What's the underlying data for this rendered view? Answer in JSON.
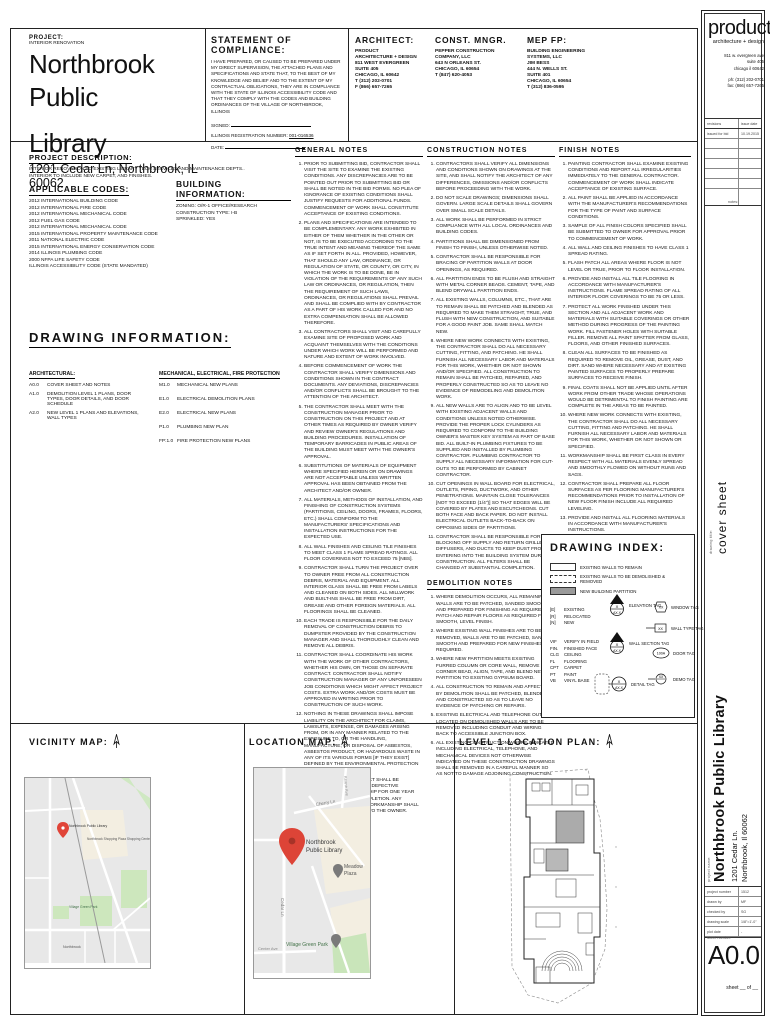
{
  "header": {
    "project_label": "PROJECT:",
    "project_sub": "INTERIOR RENOVATION",
    "project_name_line1": "Northbrook Public",
    "project_name_line2": "Library",
    "project_address": "1201 Cedar Ln, Northbrook, IL 60062",
    "compliance": {
      "title": "STATEMENT OF COMPLIANCE:",
      "body": "I HAVE PREPARED, OR CAUSED TO BE PREPARED UNDER MY DIRECT SUPERVISION, THE ATTACHED PLANS AND SPECIFICATIONS AND STATE THAT, TO THE BEST OF MY KNOWLEDGE AND BELIEF AND TO THE EXTENT OF MY CONTRACTUAL OBLIGATIONS, THEY ARE IN COMPLIANCE WITH THE STATE OF ILLINOIS ACCESSIBILITY CODE AND THAT THEY COMPLY WITH THE CODES AND BUILDING ORDINANCES OF THE VILLAGE OF NORTHBROOK, ILLINOIS",
      "signed_label": "SIGNED:",
      "reg_label": "ILLINOIS REGISTRATION NUMBER:",
      "reg_value": "001-016536",
      "date_label": "DATE:"
    },
    "architect": {
      "title": "ARCHITECT:",
      "lines": [
        "PRODUCT",
        "ARCHITECTURE + DESIGN",
        "",
        "811 WEST EVERGREEN",
        "SUITE 405",
        "CHICAGO, IL 60642",
        "T (312) 202-0701",
        "F (866) 657-7265"
      ]
    },
    "const_mngr": {
      "title": "CONST. MNGR.",
      "lines": [
        "PEPPER CONSTRUCTION",
        "COMPANY, LLC",
        "",
        "643 N ORLEANS ST.",
        "CHICAGO, IL 60654",
        "T (847) 620-4053"
      ]
    },
    "mep": {
      "title": "MEP FP:",
      "lines": [
        "BUILDING ENGINEERING",
        "SYSTEMS, LLC",
        "",
        "JIM BESS",
        "444 N. WELLS ST.",
        "SUITE 401",
        "CHICAGO, IL 60654",
        "T (312) 836-0595"
      ]
    }
  },
  "left": {
    "project_description": {
      "title": "PROJECT DESCRIPTION:",
      "lines": [
        "INTERIOR RENOVATION TO EXISTING LIBRARY TECH SERVICES AND MAINTENANCE DEPTS..",
        "INTERIOR TO INCLUDE NEW CARPET, AND FINISHES."
      ]
    },
    "applicable_codes": {
      "title": "APPLICABLE CODES:",
      "items": [
        "2012 INTERNATIONAL BUILDING CODE",
        "2012 INTERNATIONAL FIRE CODE",
        "2012 INTERNATIONAL MECHANICAL CODE",
        "2012 FUEL GAS CODE",
        "2012 INTERNATIONAL MECHANICAL  CODE",
        "2015 INTERNATIONAL PROPERTY MAINTENANCE CODE",
        "2011 NATIONAL ELECTRIC CODE",
        "2015 INTERNATIONAL ENERGY CONSERVATION CODE",
        "2014 ILLINOIS PLUMBING CODE",
        "2000 NFPA LIFE SAFETY CODE",
        "ILLINOIS ACCESSIBILITY CODE (STATE MANDATED)"
      ]
    },
    "building_information": {
      "title": "BUILDING INFORMATION:",
      "items": [
        "ZONING: O/R-1 OFFICE/RESEARCH",
        "CONSTRUCTION TYPE: I-B",
        "SPRINKLED: YES"
      ]
    },
    "drawing_information": {
      "title": "DRAWING INFORMATION:",
      "architectural": {
        "heading": "ARCHITECTURAL:",
        "items": [
          {
            "n": "A0.0",
            "t": "COVER SHEET AND NOTES"
          },
          {
            "n": "A1.0",
            "t": "DEMOLITION LEVEL 1 PLANS, DOOR TYPES, DOOR DETAILS, AND DOOR SCHEDULE"
          },
          {
            "n": "A2.0",
            "t": "NEW LEVEL 1 PLANS AND ELEVATIONS, WALL TYPES"
          }
        ]
      },
      "mep": {
        "heading": "MECHANICAL, ELECTRICAL, FIRE PROTECTION",
        "items": [
          {
            "n": "M1.0",
            "t": "MECHANICAL NEW PLANS"
          },
          {
            "n": "E1.0",
            "t": "ELECTRICAL DEMOLITION PLANS"
          },
          {
            "n": "E2.0",
            "t": "ELECTRICAL NEW PLANS"
          },
          {
            "n": "P1.0",
            "t": "PLUMBING NEW PLAN"
          },
          {
            "n": "FP:1.0",
            "t": "FIRE PROTECTION NEW PLANS"
          }
        ]
      }
    }
  },
  "notes": {
    "general": {
      "title": "GENERAL NOTES",
      "items": [
        "PRIOR TO SUBMITTING BID, CONTRACTOR SHALL VISIT THE SITE TO EXAMINE THE EXISTING CONDITIONS. ANY DISCREPANCIES ARE TO BE POINTED OUT PRIOR TO SUBMITTING BID OR SHALL BE NOTED IN THE BID FORMS. NO PLEA OF IGNORANCE OF EXISTING CONDITIONS SHALL JUSTIFY REQUESTS FOR ADDITIONAL FUNDS. COMMENCEMENT OF WORK SHALL CONSTITUTE ACCEPTANCE OF EXISTING CONDITIONS.",
        "PLANS AND SPECIFICATIONS ARE INTENDED TO BE COMPLEMENTARY. ANY WORK EXHIBITED IN EITHER OF THEM WHETHER IN THE OTHER OR NOT, IS TO BE EXECUTED ACCORDING TO THE TRUE INTENT AND MEANING THEREOF THE SAME AS IF SET FORTH IN ALL. PROVIDED, HOWEVER, THAT SHOULD ANY LAW, ORDINANCE, OR REGULATION OF STATE, OR COUNTY, OR CITY, IN WHICH THE WORK IS TO BE DONE, BE IN VIOLATION OF THE REQUIREMENTS OF ANY SUCH LAW OR ORDINANCES, OR REGULATION, THEN THE REQUIREMENT OF SUCH LAWS, ORDINANCES, OR REGULATIONS SHALL PREVAIL AND SHALL BE COMPLIED WITH BY CONTRACTOR AS A PART OF HIS WORK CALLED FOR AND NO EXTRA COMPENSATION SHALL BE ALLOWED THEREFORE.",
        "ALL CONTRACTORS SHALL VISIT AND CAREFULLY EXAMINE SITE OF PROPOSED WORK AND ACQUAINT THEMSELVES WITH THE CONDITIONS UNDER WHICH WORK WILL BE PERFORMED AND NATURE AND EXTENT OF WORK INVOLVED.",
        "BEFORE COMMENCEMENT OF WORK THE CONTRACTOR SHALL VERIFY DIMENSIONS AND CONDITIONS SHOWN IN THE CONTRACT DOCUMENTS. ANY DEVIATIONS, DISCREPANCIES AND/OR CONFLICTS SHALL BE BROUGHT TO THE ATTENTION OF THE ARCHITECT.",
        "THE CONTRACTOR SHALL MEET WITH THE CONSTRUCTION MANAGER PRIOR TO CONSTRUCTION ON THIS PROJECT AND AT OTHER TIMES AS REQUIRED BY OWNER VERIFY AND REVIEW OWNER'S REGULATIONS AND BUILDING PROCEDURES. INSTALLATION OF TEMPORARY BARRICADES IN PUBLIC AREAS OF THE BUILDING MUST MEET WITH THE OWNER'S APPROVAL.",
        "SUBSTITUTIONS OF MATERIALS OF EQUIPMENT WHERE SPECIFIED HEREIN OR ON DRAWINGS ARE NOT ACCEPTABLE UNLESS WRITTEN APPROVAL HAS BEEN OBTAINED FROM THE ARCHITECT AND/OR OWNER.",
        "ALL MATERIALS, METHODS OF INSTALLATION, AND FINISHING OF CONSTRUCTION SYSTEMS (PARTITIONS, CEILING, DOORS, FRAMES, FLOORS, ETC.) SHALL CONFORM TO THE MANUFACTURERS' SPECIFICATIONS AND INSTALLATION INSTRUCTIONS FOR THE EXPECTED USE.",
        "ALL WALL FINISHES AND CEILING TILE FINISHES TO MEET CLASS 1 FLAME SPREAD RATINGS. ALL FLOOR COVERINGS NOT TO EXCEED 75 [NBS].",
        "CONTRACTOR SHALL TURN THE PROJECT OVER TO OWNER FREE FROM ALL CONSTRUCTION DEBRIS, MATERIAL AND EQUIPMENT. ALL INTERIOR GLASS SHALL BE FREE FROM LABELS AND CLEANED ON BOTH SIDES. ALL MILLWORK AND BUILT-INS SHALL BE FREE FROM DIRT, GREASE AND OTHER FOREIGN MATERIALS. ALL FLOORINGS SHALL BE CLEANED.",
        "EACH TRADE IS RESPONSIBLE FOR THE DAILY REMOVAL OF CONSTRUCTION DEBRIS TO DUMPSTER PROVIDED BY THE CONSTRUCTION MANAGER AND SHALL THOROUGHLY CLEAN AND REMOVE ALL DEBRIS.",
        "CONTRACTOR SHALL COORDINATE HIS WORK WITH THE WORK OF OTHER CONTRACTORS, WHETHER HIS OWN, OR THOSE ON SEPARATE CONTRACT. CONTRACTOR SHALL NOTIFY CONSTRUCTION MANAGER OF ANY UNFORESEEN JOB CONDITIONS WHICH MIGHT AFFECT PROJECT COSTS. EXTRA WORK AND/OR COSTS MUST BE APPROVED IN WRITING PRIOR TO CONSTRUCTION OF SUCH WORK.",
        "NOTHING IN THESE DRAWINGS SHALL IMPOSE LIABILITY ON THE ARCHITECT FOR CLAIMS, LAWSUITS, EXPENSE, OR DAMAGES ARISING FROM, OR IN ANY MANNER RELATED TO THE EXPOSURE TO, OR THE HANDLING, MANUFACTURE, OR DISPOSAL OF ASBESTOS, ASBESTOS PRODUCT, OR HAZARDOUS WASTE IN ANY OF ITS VARIOUS FORMS [IF THEY EXIST] DEFINED BY THE ENVIRONMENTAL PROTECTION AGENCY.",
        "ALL WORK IN THIS CONTRACT SHALL BE GUARANTEED AGAINST ANY DEFECTIVE MATERIALS OF WORKMANSHIP FOR ONE YEAR AFTER DATE OF FINAL COMPLETION. ANY DEFECTIVE MATERIAL OR WORKMANSHIP SHALL BE REPLACED AT NO COST TO THE OWNER."
      ]
    },
    "construction": {
      "title": "CONSTRUCTION NOTES",
      "items": [
        "CONTRACTORS SHALL VERIFY ALL DIMENSIONS AND CONDITIONS SHOWN ON DRAWINGS AT THE SITE, AND SHALL NOTIFY THE ARCHITECT OF ANY DIFFERENCES, OMISSIONS AND/OR CONFLICTS BEFORE PROCEEDING WITH THE WORK.",
        "DO NOT SCALE DRAWINGS; DIMENSIONS SHALL GOVERN. LARGE SCALE DETAILS SHALL GOVERN OVER SMALL SCALE DETAILS.",
        "ALL WORK SHALL BE PERFORMED IN STRICT COMPLIANCE WITH ALL LOCAL ORDINANCES AND BUILDING CODES.",
        "PARTITIONS SHALL BE DIMENSIONED FROM FINISH TO FINISH, UNLESS OTHERWISE NOTED.",
        "CONTRACTOR SHALL BE RESPONSIBLE FOR BRACING OF PARTITION WALLS AT DOOR OPENINGS, AS REQUIRED.",
        "ALL PARTITION ENDS TO BE FLUSH AND STRAIGHT WITH METAL CORNER BEADS. CEMENT, TAPE, AND BLEND DRYWALL PARTITION ENDS.",
        "ALL EXISTING WALLS, COLUMNS, ETC., THAT ARE TO REMAIN SHALL BE PATCHED AND BLENDED AS REQUIRED TO MAKE THEM STRAIGHT, TRUE, AND FLUSH WITH NEW CONSTRUCTION, AND SUITABLE FOR A GOOD PAINT JOB. SAME SHALL MATCH NEW.",
        "WHERE NEW WORK CONNECTS WITH EXISTING, THE CONTRACTOR SHALL DO ALL NECESSARY CUTTING, FITTING, AND PATCHING. HE SHALL FURNISH ALL NECESSARY LABOR AND MATERIALS FOR THIS WORK, WHETHER OR NOT SHOWN AND/OR SPECIFIED. ALL CONSTRUCTION TO REMAIN SHALL BE PATCHED, REPAIRED, AND PROPERLY CONSTRUCTED SO AS TO LEAVE NO EVIDENCE OF REMODELING AND DEMOLITION WORK.",
        "ALL NEW WALLS ARE TO ALIGN AND TO BE LEVEL WITH EXISTING ADJACENT WALLS AND CONDITIONS UNLESS NOTED OTHERWISE. PROVIDE THE PROPER LOCK CYLINDERS AS REQUIRED TO CONFORM TO THE BUILDING OWNER'S MASTER KEY SYSTEM AS PART OF BASE BID. ALL BUILT-IN PLUMBING FIXTURES TO BE SUPPLIED AND INSTALLED BY PLUMBING CONTRACTOR. PLUMBING CONTRACTOR TO SUPPLY ALL NECESSARY INFORMATION FOR CUT-OUTS TO BE PERFORMED BY CABINET CONTRACTOR.",
        "CUT OPENINGS IN WALL BOARD FOR ELECTRICAL, OUTLETS, PIPING, DUCTWORK, AND OTHER PENETRATIONS. MAINTAIN CLOSE TOLERANCES [NOT TO EXCEED (1/4\")] SO THAT EDGES WILL BE COVERED BY PLATES AND ESCUTCHEONS. CUT BOTH FACE AND BACK PAPER. DO NOT INSTALL ELECTRICAL OUTLETS BACK-TO-BACK ON OPPOSING SIDES OF PARTITIONS.",
        "CONTRACTOR SHALL BE RESPONSIBLE FOR BLOCKING OFF SUPPLY AND RETURN GRILLES, DIFFUSERS, AND DUCTS TO KEEP DUST FROM ENTERING INTO THE BUILDING SYSTEM DURING CONSTRUCTION. ALL FILTERS SHALL BE CHANGED AT SUBSTANTIAL COMPLETION."
      ]
    },
    "demolition": {
      "title": "DEMOLITION NOTES",
      "items": [
        "WHERE DEMOLITION OCCURS, ALL REMAINING WALLS ARE TO BE PATCHED, SANDED SMOOTH AND PREPARED FOR FINISHING AS REQUIRED. PATCH AND REPAIR FLOORS AS REQUIRED FOR SMOOTH, LEVEL FINISH.",
        "WHERE EXISTING WALL FINISHES ARE TO BE REMOVED, WALLS ARE TO BE PATCHED, SANDED SMOOTH AND PREPARED FOR NEW FINISHES AS REQUIRED.",
        "WHERE NEW PARTITION MEETS EXISTING FURRED COLUMN OR CORE WALL, REMOVE CORNER BEAD, ALIGN, TAPE, AND BLEND NEW PARTITION TO EXISTING GYPSUM BOARD.",
        "ALL CONSTRUCTION TO REMAIN AND AFFECTED BY DEMOLITION SHALL BE PATCHED, BLENDED AND CONSTRUCTED SO AS TO LEAVE NO EVIDENCE OF PATCHING OR REPAIRS.",
        "EXISTING ELECTRICAL AND TELEPHONE OUTLETS LOCATED ON DEMOLISHED WALLS ARE TO BE REMOVED INCLUDING CONDUIT AND WIRING BACK TO ACCESSIBLE JUNCTION BOX.",
        "ALL EXISTING CONSTRUCTION WHERE INDICATED INCLUDING ELECTRICAL, TELEPHONE, AND MECHANICAL DEVICES NOT OTHERWISE INDICATED ON THESE CONSTRUCTION DRAWINGS SHALL BE REMOVED IN A CAREFUL MANNER SO AS NOT TO DAMAGE ADJOINING CONSTRUCTION."
      ]
    },
    "finish": {
      "title": "FINISH NOTES",
      "items": [
        "PAINTING CONTRACTOR SHALL EXAMINE EXISTING CONDITIONS AND REPORT ALL IRREGULARITIES IMMEDIATELY TO THE GENERAL CONTRACTOR. COMMENCEMENT OF WORK SHALL INDICATE ACCEPTANCE OF EXISTING SURFACE.",
        "ALL PAINT SHALL BE APPLIED IN ACCORDANCE WITH THE MANUFACTURER'S RECOMMENDATIONS FOR THE TYPE OF PAINT AND SURFACE CONDITIONS.",
        "SAMPLE OF ALL FINISH COLORS SPECIFIED SHALL BE SUBMITTED TO OWNER FOR APPROVAL PRIOR TO COMMENCEMENT OF WORK.",
        "ALL WALL AND CEILING FINISHES TO HAVE CLASS 1 SPREAD RATING.",
        "FLASH PATCH ALL AREAS WHERE FLOOR IS NOT LEVEL OR TRUE, PRIOR TO FLOOR INSTALLATION.",
        "PROVIDE AND INSTALL ALL TILE FLOORING IN ACCORDANCE WITH MANUFACTURER'S INSTRUCTIONS. FLAME SPREAD RATING OF ALL INTERIOR FLOOR COVERINGS TO BE 75 OR LESS.",
        "PROTECT ALL WORK FINISHED UNDER THIS SECTION AND ALL ADJACENT WORK AND MATERIALS WITH SUITABLE COVERINGS OR OTHER METHOD DURING PROGRESS OF THE PAINTING WORK. FILL FASTENER HOLES WITH SUITABLE FILLER. REMOVE ALL PAINT SPATTER FROM GLASS, FLOORS, AND OTHER FINISHED SURFACES.",
        "CLEAN ALL SURFACES TO BE FINISHED AS REQUIRED TO REMOVE OIL, GREASE, DUST, AND DIRT. SAND WHERE NECESSARY AND AT EXISTING PAINTED SURFACES TO PROPERLY PREPARE SURFACES TO RECEIVE FINISH.",
        "FINAL COATS SHALL NOT BE APPLIED UNTIL AFTER WORK FROM OTHER TRADE WHOSE OPERATIONS WOULD BE DETRIMENTAL TO FINISH PAINTING ARE COMPLETE IN THE AREAS TO BE PAINTED.",
        "WHERE NEW WORK CONNECTS WITH EXISTING, THE CONTRACTOR SHALL DO ALL NECESSARY CUTTING, FITTING AND PATCHING. HE SHALL FURNISH ALL NECESSARY LABOR AND MATERIALS FOR THIS WORK, WHETHER OR NOT SHOWN OR SPECIFIED.",
        "WORKMANSHIP SHALL BE FIRST CLASS IN EVERY RESPECT WITH ALL MATERIALS EVENLY SPREAD AND SMOOTHLY FLOWED ON WITHOUT RUNS AND SAGS.",
        "CONTRACTOR SHALL PREPARE ALL FLOOR SURFACES AS PER FLOORING MANUFACTURER'S RECOMMENDATIONS PRIOR TO INSTALLATION OF NEW FLOOR FINISH INCLUDE ALL REQUIRED LEVELING.",
        "PROVIDE AND INSTALL ALL FLOORING MATERIALS IN ACCORDANCE WITH MANUFACTURER'S INSTRUCTIONS."
      ]
    },
    "rcp": {
      "title": "REFLECTED CEILING NOTES:",
      "items": [
        "INSTALL ALL MATERIALS AND SYSTEMS IN ACCORDANCE WITH MANUFACTURERS' SPECIFICATIONS AND ALL LOCAL AND STATE CODES WHICH HAVE AUTHORITY OVER THIS WORK.",
        "FINAL DETERMINATION OF QUALITY AND LOCATION REQUIREMENTS OF EXIT SIGNS IS SUBJECT TO APPROVAL OF THE BUREAU OF FIRE PREVENTION OF THE MUNICIPAL AGENCY HAVING JURISDICTION.",
        "COORDINATE THE SPACING OF ALL HANGERS, CARRYING CHANNELS, RUNNERS, AND MOLDING WITH THE LOCATION OF ELECTRICAL FIXTURES AND OTHER ITEMS OCCURRING IN OR ON THE CEILING.",
        "IF CEILING DIFFUSERS, LIGHT FIXTURES OR OTHER ELEMENTS ON OR ABOVE THE CEILING CANNOT BE LOCATED AS SHOWN ON THE DRAWINGS, SUCH CONFLICT SHALL BE REPORTED IMMEDIATELY TO THE ARCHITECT FOR RELOCATION."
      ]
    }
  },
  "drawing_index": {
    "title": "DRAWING INDEX:",
    "legend": {
      "remain": "EXISTING WALLS TO REMAIN",
      "demolished": "EXISTING WALLS TO BE DEMOLISHED & REMOVED",
      "new_partition": "NEW BUILDING PARTITION"
    },
    "statuses": [
      [
        "[E]",
        "EXISTING"
      ],
      [
        "[R]",
        "RELOCATED"
      ],
      [
        "[N]",
        "NEW"
      ]
    ],
    "abbreviations": [
      [
        "VIF",
        "VERIFY IN FIELD"
      ],
      [
        "FIN.",
        "FINISHED FACE"
      ],
      [
        "CLG",
        "CEILING"
      ],
      [
        "FL",
        "FLOORING"
      ],
      [
        "CPT",
        "CARPET"
      ],
      [
        "PT",
        "PAINT"
      ],
      [
        "VB",
        "VINYL BASE"
      ]
    ],
    "tags": {
      "elevation": {
        "label": "ELEVATION TAG",
        "top": "X",
        "bottom": "AX.X"
      },
      "wall_section": {
        "label": "WALL SECTION TAG",
        "top": "X",
        "bottom": "AX.X"
      },
      "detail": {
        "label": "DETAIL TAG",
        "top": "X",
        "bottom": "AX.X"
      },
      "window": {
        "label": "WINDOW TAG",
        "value": "XX"
      },
      "wall_type": {
        "label": "WALL TYPE TAG",
        "value": "XX"
      },
      "door": {
        "label": "DOOR TAG",
        "value": "100A"
      },
      "demo": {
        "label": "DEMO TAG",
        "value": "XX"
      }
    }
  },
  "maps": {
    "vicinity": {
      "title": "VICINITY MAP:",
      "labels": {
        "library": "Northbrook Public Library",
        "plaza": "Northbrook Shopping Plaza Shopping Center",
        "park": "Village Green Park",
        "town": "Northbrook"
      }
    },
    "location": {
      "title": "LOCATION MAP:",
      "labels": {
        "library1": "Northbrook",
        "library2": "Public Library",
        "cherry": "Cherry Ln",
        "cedar": "Cedar Ln",
        "keane": "Keane Ave",
        "meadow1": "Meadow",
        "meadow2": "Plaza",
        "park": "Village Green Park",
        "center": "Center Ave"
      }
    },
    "plan": {
      "title": "LEVEL 1 LOCATION PLAN:"
    }
  },
  "titleblock": {
    "logo_name": "product",
    "logo_tagline": "architecture + design",
    "addr1": "811 w. evergreen ave",
    "addr2": "suite 405",
    "addr3": "chicago il 60642",
    "phone": "ph: (312) 202-0701",
    "fax": "fax: (866) 657-7265",
    "rev_col1": "revisions",
    "rev_col2": "issue date",
    "rev_rows": [
      [
        "issued for bid",
        "10.19.2015"
      ],
      [
        "",
        ""
      ],
      [
        "",
        ""
      ],
      [
        "",
        ""
      ],
      [
        "",
        ""
      ],
      [
        "",
        ""
      ]
    ],
    "notes_label": "notes:",
    "drawing_title_label": "drawing title:",
    "drawing_title": "cover sheet",
    "project_label": "project name:",
    "project_name": "Northbrook Public Library",
    "project_addr1": "1201 Cedar Ln.",
    "project_addr2": "Northbrook, Il 60062",
    "info_rows": [
      [
        "project number",
        "1512"
      ],
      [
        "drawn by",
        "MF"
      ],
      [
        "checked by",
        "SG"
      ],
      [
        "drawing scale",
        "1/8\"=1'-0\""
      ],
      [
        "plot date",
        "-"
      ]
    ],
    "sheet_number_label": "sheet number:",
    "sheet_number": "A0.0",
    "sheet_of": "sheet __ of __"
  }
}
